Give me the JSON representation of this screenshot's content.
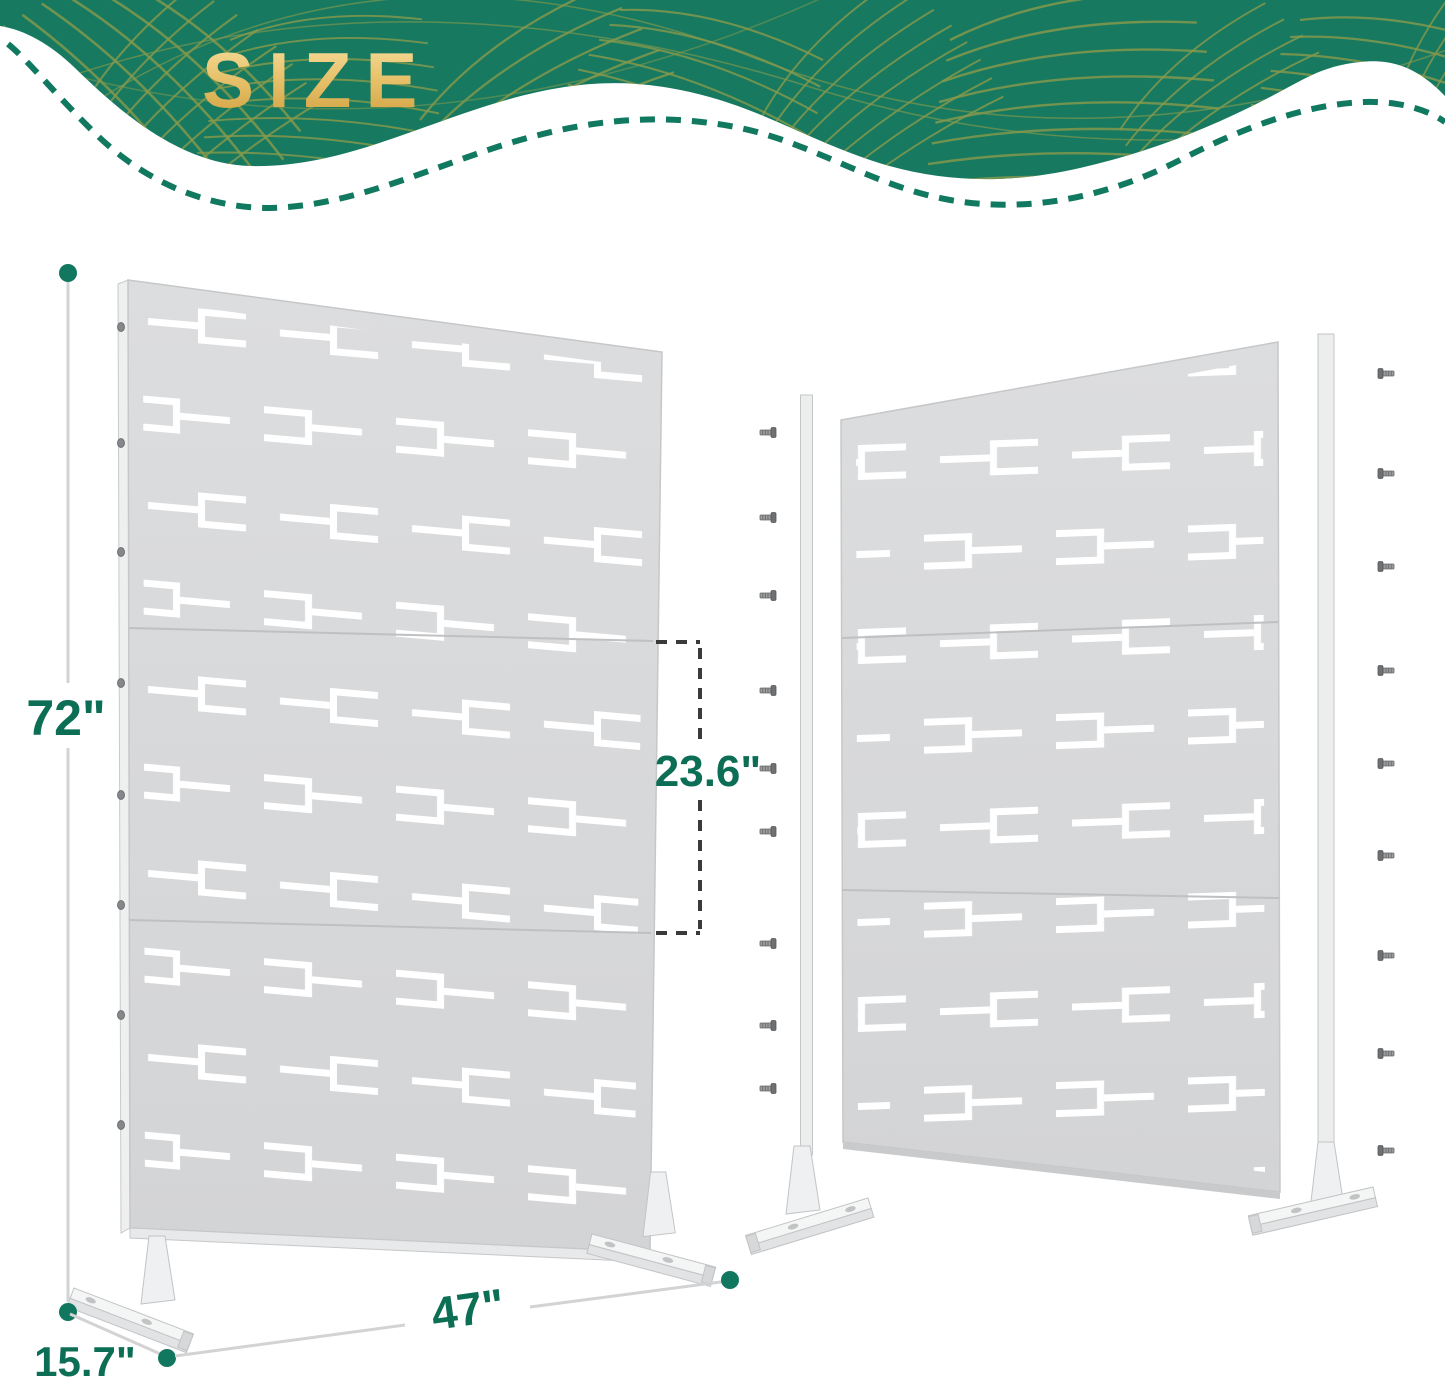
{
  "banner": {
    "title": "SIZE"
  },
  "dimensions": {
    "height": "72\"",
    "panel_section_height": "23.6\"",
    "width": "47\"",
    "base_depth": "15.7\""
  },
  "colors": {
    "banner_green": "#177a60",
    "leaf_line_gold": "#8a9a4c",
    "title_gold": "#e9c46e",
    "dashed_border_green": "#11795f",
    "dimension_text_green": "#0d6e56",
    "dimension_dot_green": "#12775f",
    "dimension_line_gray": "#d2d3d5",
    "section_bracket_dash_gray": "#3a3a3a",
    "panel_gray": "#d8d9db",
    "panel_cutout_white": "#ffffff",
    "screw_gray": "#6e7072"
  },
  "icons": {
    "screw": "screw-icon",
    "dimension_dot": "dimension-endpoint-dot"
  }
}
